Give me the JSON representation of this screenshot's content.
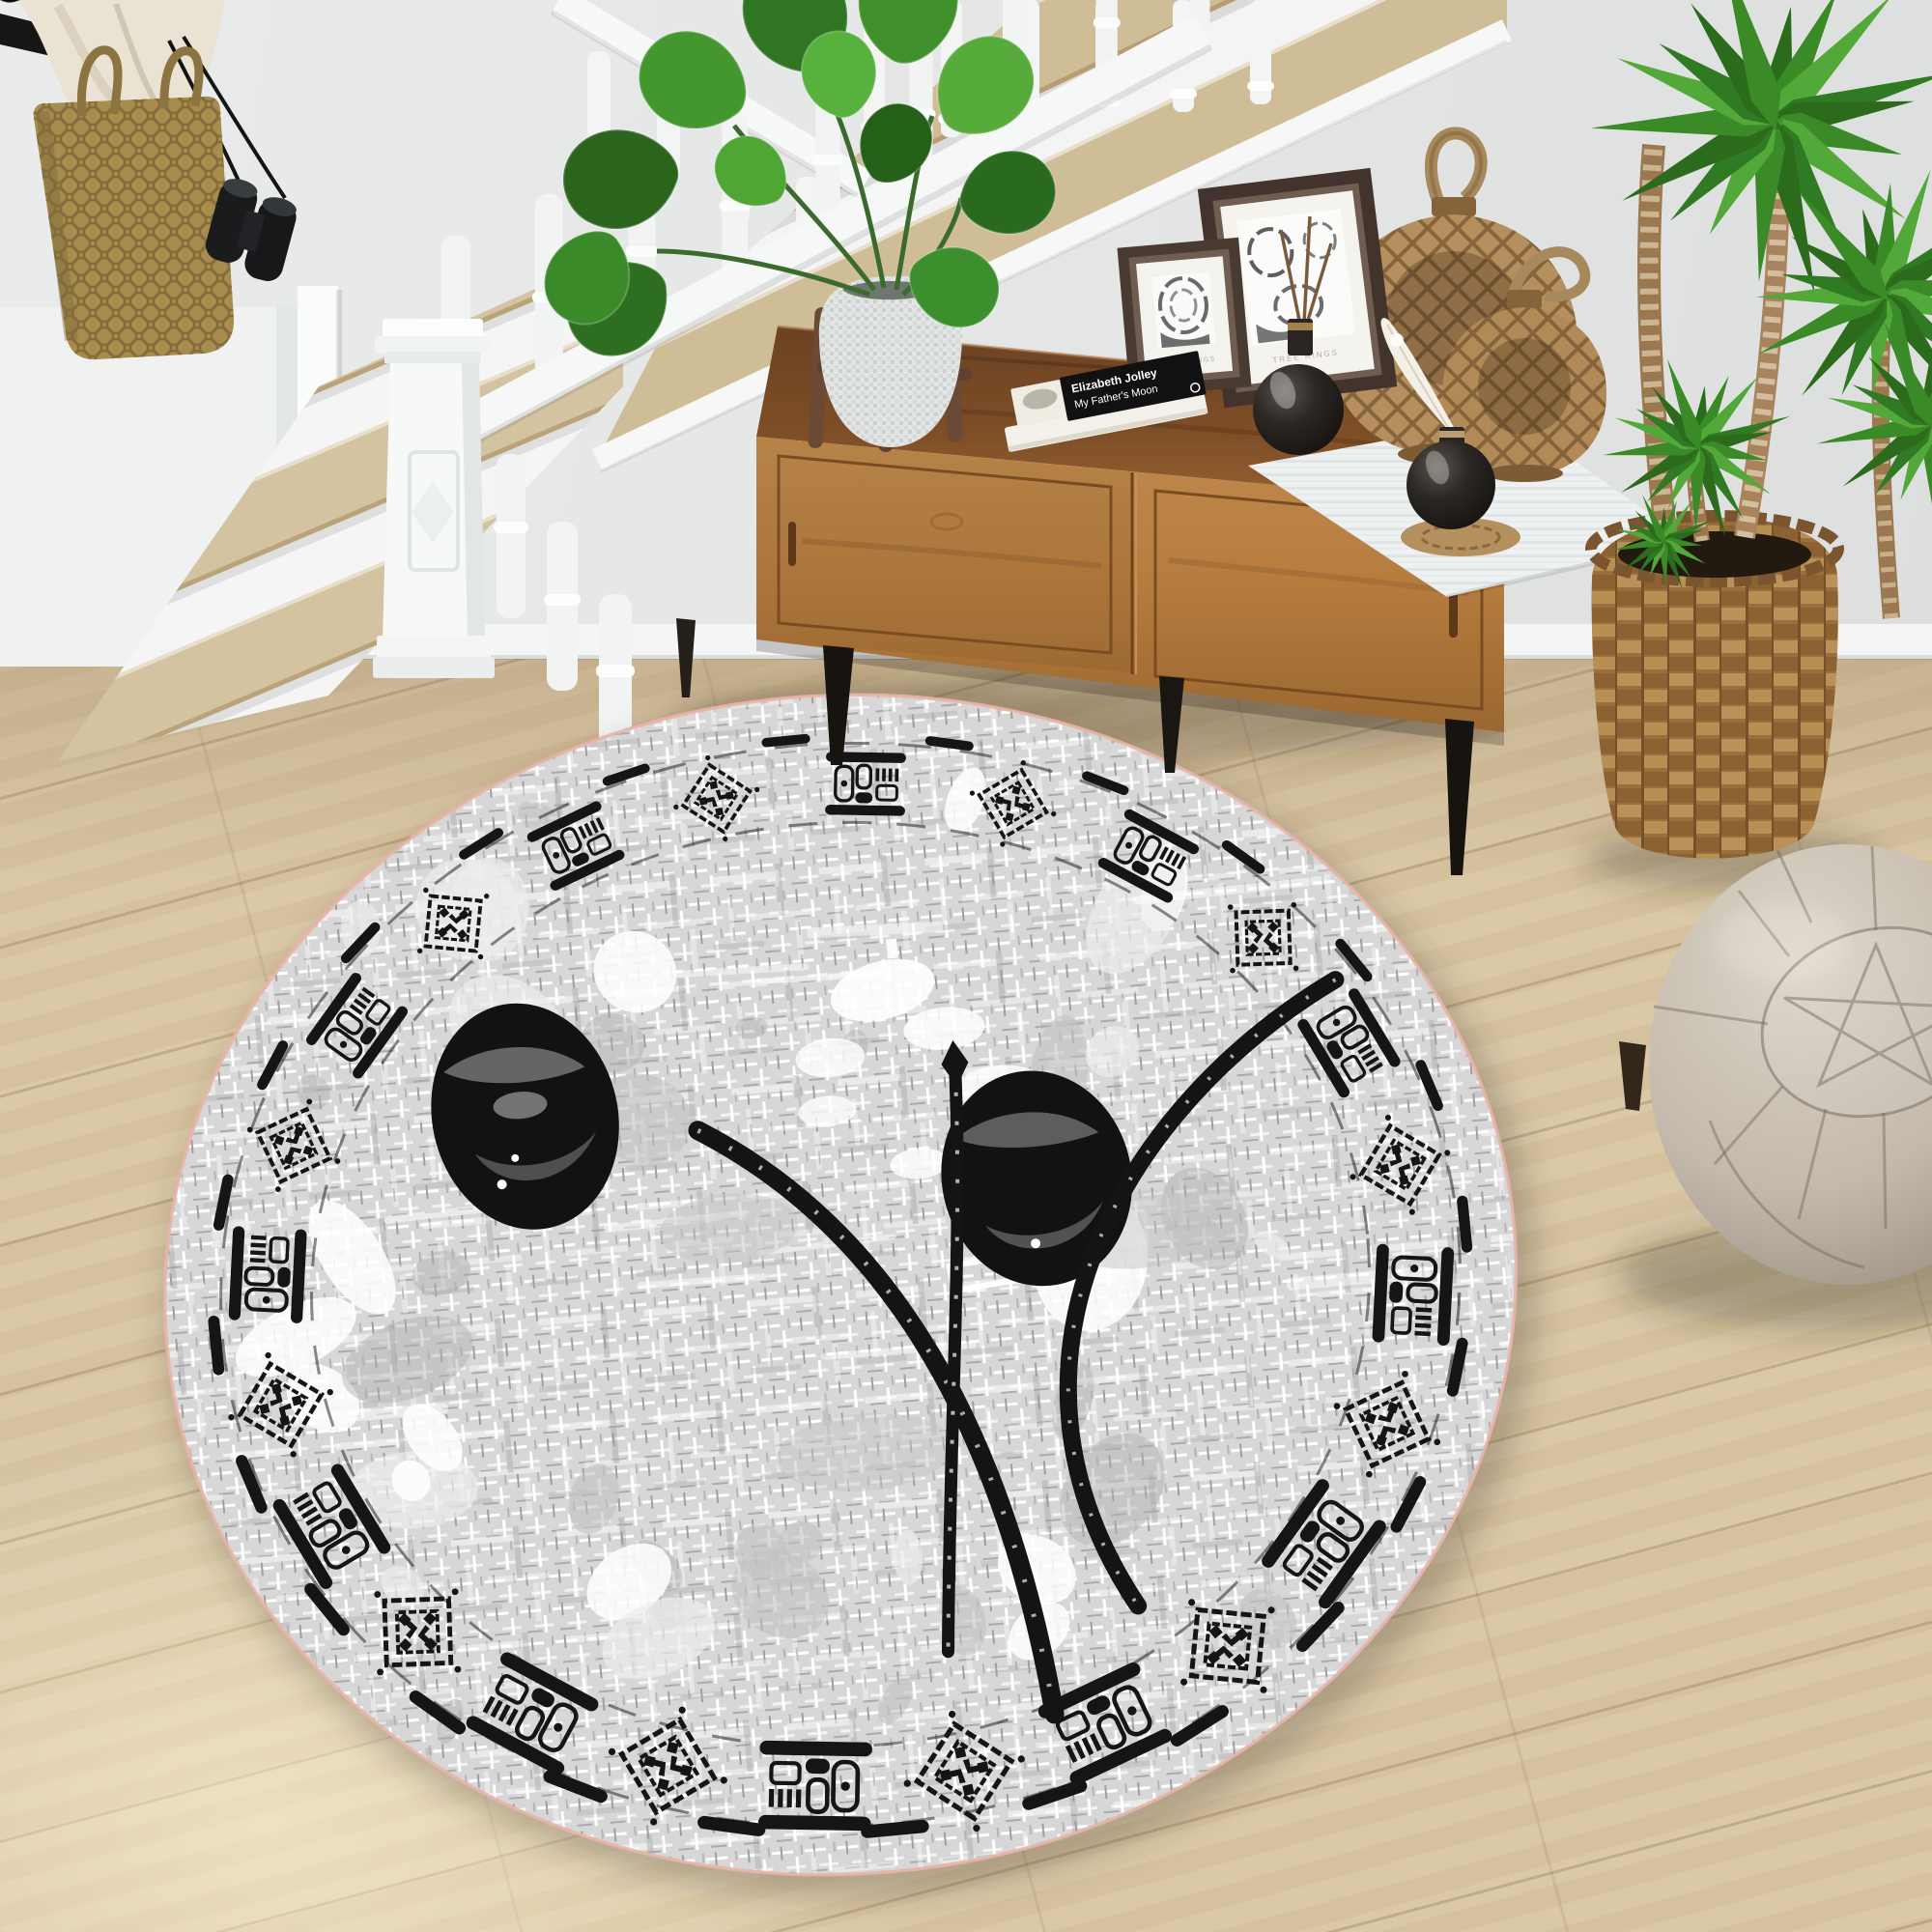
{
  "scene": {
    "description": "Top-down interior hallway photo: white staircase, wooden sideboard with decor, plants, beige pouf and large oval tribal rug",
    "colors": {
      "wall": "#e5e7e7",
      "floor_wood": "#d8c5a2",
      "stair_tread": "#cfbd98",
      "stair_paint": "#f3f4f3",
      "cabinet_top": "#7e4e27",
      "cabinet_front": "#b57c3e",
      "cabinet_leg": "#17140f",
      "rattan": "#b68f5e",
      "basket": "#996f3d",
      "pouf": "#c3b9ac",
      "plant_green": "#3a8a28",
      "rug_base": "#d7d7d7",
      "rug_ink": "#151515",
      "rug_edge_pink": "#e8b4aa",
      "vase_glass": "#1c1916",
      "bag_straw": "#a78c4e",
      "book_cover": "#111111"
    }
  },
  "rug": {
    "shape": "oval",
    "style": "distressed weave, tribal motif border ring, two black ovals with brush arcs and center line",
    "base_color": "#d7d7d7",
    "ink_color": "#151515",
    "edge_color": "#e8b4aa"
  },
  "book": {
    "author": "Elizabeth Jolley",
    "title": "My Father's Moon"
  },
  "frames": [
    {
      "caption": "TREE RINGS"
    },
    {
      "caption": "TREE RINGS"
    }
  ]
}
